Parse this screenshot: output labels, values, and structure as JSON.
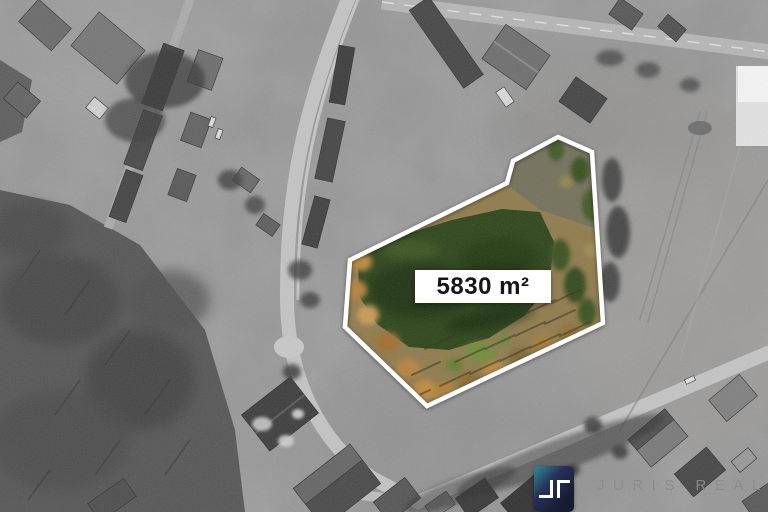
{
  "scene": {
    "style": "grayscale-aerial-photo",
    "highlight": "colored land parcel outlined in white"
  },
  "parcel": {
    "area_label": "5830 m²",
    "outline_points": "558,137 592,152 603,323 427,406 345,327 350,260 507,183 513,161",
    "outline_color": "#ffffff",
    "label_bg": "#ffffff",
    "label_text_color": "#161616",
    "terrain_colors": {
      "pond": "#2c451a",
      "pond_shadow": "#1d3110",
      "ground": "#8f7b4c",
      "trees_orange": "#b5823f",
      "trees_green": "#3a5220",
      "grass": "#6c8f3a"
    }
  },
  "branding": {
    "name": "JURIS REAL",
    "mark": "jr-brackets-icon",
    "mark_teal": "#2f8f96",
    "mark_navy": "#181c31",
    "mark_glyph_color": "#ffffff",
    "name_color": "#878b90"
  }
}
